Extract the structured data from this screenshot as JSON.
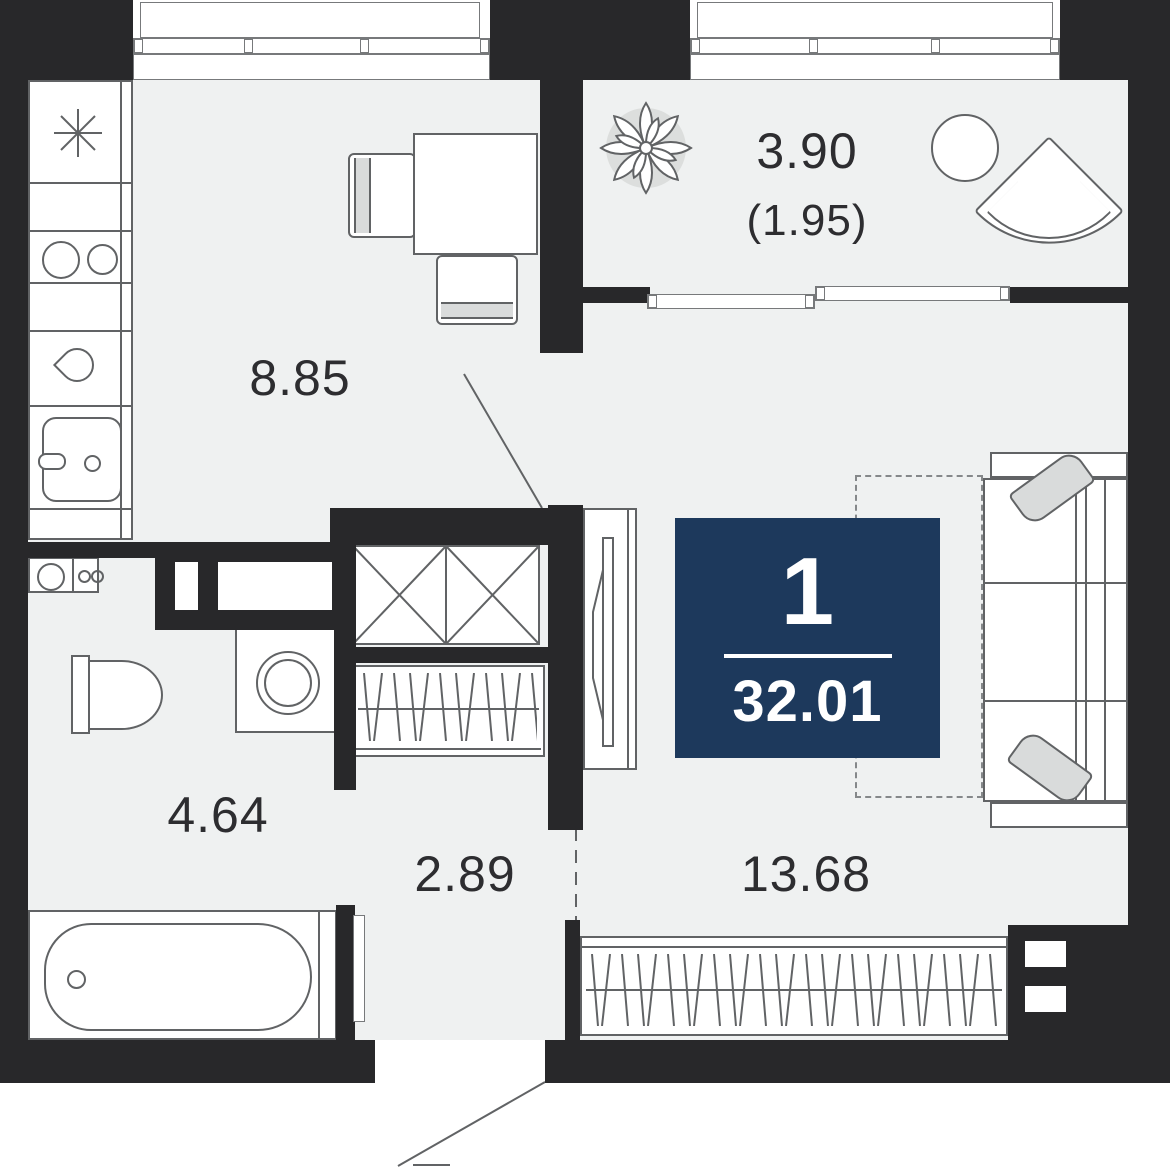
{
  "plan": {
    "type": "apartment-floor-plan",
    "badge": {
      "room_count": "1",
      "total_area": "32.01"
    },
    "rooms": {
      "kitchen": {
        "area": "8.85"
      },
      "balcony": {
        "area": "3.90",
        "area_reduced": "(1.95)"
      },
      "bathroom": {
        "area": "4.64"
      },
      "hallway": {
        "area": "2.89"
      },
      "living": {
        "area": "13.68"
      }
    },
    "icons": {
      "plant": "potted-plant",
      "asterisk": "kitchen-asterisk-mark",
      "fixtures": [
        "cooktop",
        "kitchen-sink",
        "washbasin",
        "toilet",
        "washing-machine",
        "bathtub",
        "sofa",
        "wardrobe",
        "tv-stand",
        "dining-table",
        "armchair",
        "round-table",
        "radiator"
      ]
    },
    "colors": {
      "wall": "#28282a",
      "floor": "#eff1f1",
      "accent": "#1d395c",
      "outline": "#616365",
      "text": "#2d2d30"
    }
  }
}
